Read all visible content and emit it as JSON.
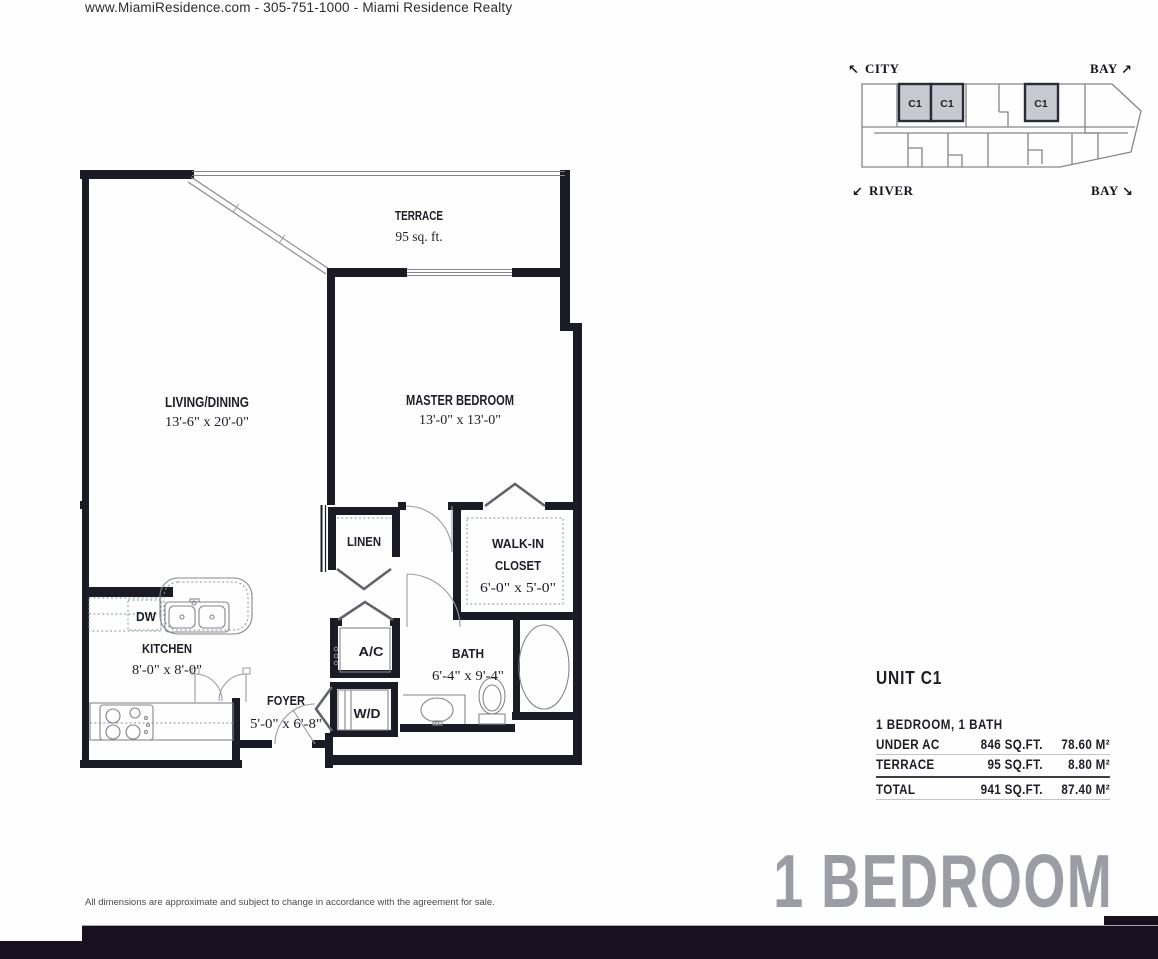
{
  "header": {
    "contact_line": "www.MiamiResidence.com  -  305-751-1000  -  Miami Residence Realty"
  },
  "key_plan": {
    "corner_labels": {
      "top_left": "CITY",
      "top_right": "BAY",
      "bottom_left": "RIVER",
      "bottom_right": "BAY"
    },
    "arrows": {
      "top_left": "↖",
      "top_right": "↗",
      "bottom_left": "↙",
      "bottom_right": "↘"
    },
    "highlighted_units": [
      "C1",
      "C1",
      "C1"
    ]
  },
  "floor_plan": {
    "terrace": {
      "name": "TERRACE",
      "area": "95 sq. ft."
    },
    "living_dining": {
      "name": "LIVING/DINING",
      "dims": "13'-6\" x 20'-0\""
    },
    "master_bedroom": {
      "name": "MASTER BEDROOM",
      "dims": "13'-0\" x 13'-0\""
    },
    "linen": {
      "name": "LINEN"
    },
    "walk_in_closet": {
      "name_line1": "WALK-IN",
      "name_line2": "CLOSET",
      "dims": "6'-0\" x 5'-0\""
    },
    "ac": {
      "name": "A/C"
    },
    "wd": {
      "name": "W/D"
    },
    "bath": {
      "name": "BATH",
      "dims": "6'-4\" x 9'-4\""
    },
    "kitchen": {
      "name": "KITCHEN",
      "dims": "8'-0\" x 8'-0\""
    },
    "dw": {
      "name": "DW"
    },
    "foyer": {
      "name": "FOYER",
      "dims": "5'-0\" x 6'-8\""
    }
  },
  "unit_info": {
    "title": "UNIT C1",
    "subtitle": "1 BEDROOM, 1 BATH",
    "rows": [
      {
        "label": "UNDER AC",
        "sqft": "846 SQ.FT.",
        "m2": "78.60 M²"
      },
      {
        "label": "TERRACE",
        "sqft": "95 SQ.FT.",
        "m2": "8.80 M²"
      },
      {
        "label": "TOTAL",
        "sqft": "941 SQ.FT.",
        "m2": "87.40 M²"
      }
    ]
  },
  "footer": {
    "type_label": "1 BEDROOM",
    "disclaimer": "All dimensions are approximate and subject to change in accordance with the agreement for sale."
  },
  "colors": {
    "wall": "#1b1b26",
    "unit_fill": "#c9c9d2",
    "type_label_gray": "#9b9ca4",
    "footer_bar": "#1a1120",
    "dashed_counter": "#7f9a8f"
  }
}
